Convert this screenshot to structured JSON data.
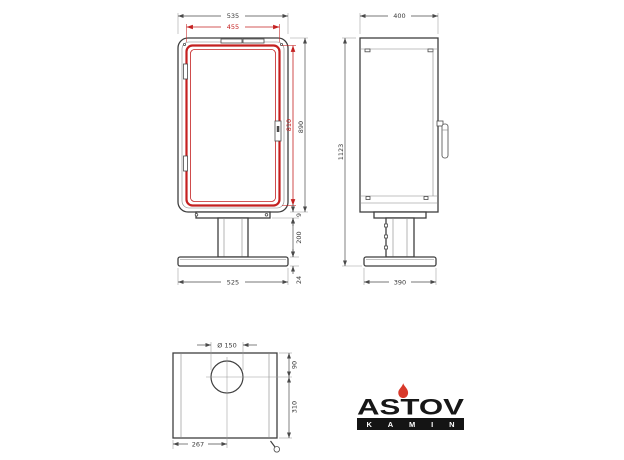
{
  "front": {
    "total_width": "535",
    "door_width": "455",
    "total_height": "890",
    "door_height": "810",
    "plate_gap": "9",
    "pedestal_height": "200",
    "base_thickness": "24",
    "base_width": "525"
  },
  "side": {
    "depth": "400",
    "overall_height": "1123",
    "base_depth": "390"
  },
  "top": {
    "flue_diameter": "Ø 150",
    "flue_from_back": "90",
    "flue_to_front": "310",
    "flue_from_left": "267"
  },
  "logo": {
    "brand": "ASTOV",
    "sub": "KAMIN"
  },
  "colors": {
    "highlight_red": "#c42020",
    "drawing_line": "#3f3f3f",
    "logo_black": "#171717",
    "flame_red": "#d8392b",
    "background": "#ffffff"
  }
}
